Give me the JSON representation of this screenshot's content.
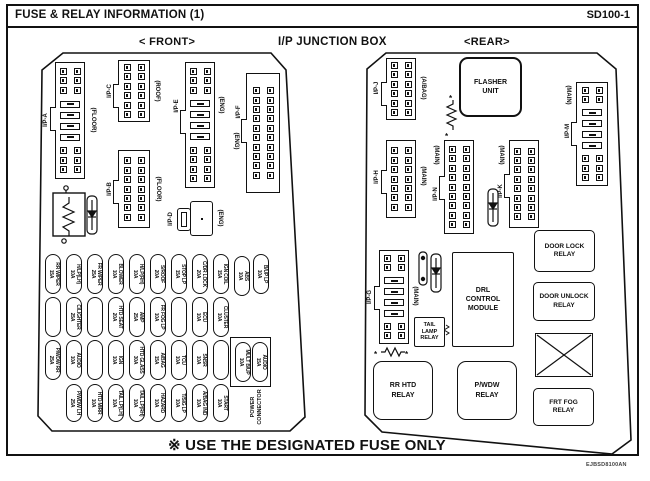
{
  "header": {
    "title": "FUSE & RELAY INFORMATION (1)",
    "page_code": "SD100-1"
  },
  "sections": {
    "front": "< FRONT>",
    "center": "I/P JUNCTION BOX",
    "rear": "<REAR>"
  },
  "footer": {
    "note": "※ USE THE DESIGNATED FUSE ONLY",
    "doc_code": "EJBSD8100AN"
  },
  "connectors": {
    "ipa": {
      "name": "I/P-A",
      "loc": "(FLOOR)"
    },
    "ipb": {
      "name": "I/P-B",
      "loc": "(FLOOR)"
    },
    "ipc": {
      "name": "I/P-C",
      "loc": "(ROOF)"
    },
    "ipd": {
      "name": "I/P-D",
      "loc": "(ENG)"
    },
    "ipe": {
      "name": "I/P-E",
      "loc": "(ENG)"
    },
    "ipf": {
      "name": "I/P-F",
      "loc": "(ENG)"
    },
    "ipg": {
      "name": "I/P-G",
      "loc": "(MAIN)"
    },
    "iph": {
      "name": "I/P-H",
      "loc": "(MAIN)"
    },
    "ipj": {
      "name": "I/P-J",
      "loc": "(A/BAG)"
    },
    "ipk": {
      "name": "I/P-K",
      "loc": "(MAIN)"
    },
    "ipm": {
      "name": "I/P-M",
      "loc": "(MAIN)"
    },
    "ipn": {
      "name": "I/P-N",
      "loc": "(MAIN)"
    }
  },
  "relays": {
    "flasher": "FLASHER\nUNIT",
    "tail_lamp": "TAIL\nLAMP\nRELAY",
    "drl": "DRL\nCONTROL\nMODULE",
    "rr_htd": "RR HTD\nRELAY",
    "pwdw": "P/WDW\nRELAY",
    "door_lock": "DOOR LOCK\nRELAY",
    "door_unlock": "DOOR UNLOCK\nRELAY",
    "frt_fog": "FRT FOG\nRELAY"
  },
  "fuse_panel": {
    "power_connector": [
      "POWER",
      "CONNECTOR"
    ],
    "rows": [
      [
        {
          "name": "RR WIPER",
          "amp": "15A"
        },
        {
          "name": "H/LP(LH)",
          "amp": "10A"
        },
        {
          "name": "FR WIPER",
          "amp": "25A"
        },
        {
          "name": "BLOWER",
          "amp": "10A"
        },
        {
          "name": "H/LP(RH)",
          "amp": "10A"
        },
        {
          "name": "S/ROOF",
          "amp": "20A"
        },
        {
          "name": "STOP LP",
          "amp": "15A"
        },
        {
          "name": "C/DR LOCK",
          "amp": "20A"
        },
        {
          "name": "IGN COIL",
          "amp": "15A"
        },
        {
          "name": "ABS",
          "amp": "10A"
        },
        {
          "name": "B/UP LP",
          "amp": "10A"
        }
      ],
      [
        null,
        {
          "name": "C/LIGHTER",
          "amp": "25A"
        },
        null,
        {
          "name": "HTD SEAT",
          "amp": "20A"
        },
        {
          "name": "AMP",
          "amp": "25A"
        },
        {
          "name": "FR FOG LP",
          "amp": "10A"
        },
        null,
        {
          "name": "ECU",
          "amp": "10A"
        },
        {
          "name": "CLUSTER",
          "amp": "10A"
        }
      ],
      [
        {
          "name": "P/WDW RR",
          "amp": "25A"
        },
        {
          "name": "AUDIO",
          "amp": "10A"
        },
        null,
        {
          "name": "IGN",
          "amp": "10A"
        },
        {
          "name": "HTD GLASS",
          "amp": "30A"
        },
        {
          "name": "A/BAG",
          "amp": "15A"
        },
        {
          "name": "TCU",
          "amp": "10A"
        },
        {
          "name": "SNSR",
          "amp": "10A"
        },
        null,
        {
          "name": "MULT B/UP",
          "amp": "10A"
        },
        {
          "name": "AUDIO",
          "amp": "15A"
        }
      ],
      [
        {
          "name": "P/WDW LH",
          "amp": "25A"
        },
        {
          "name": "HTD MIRR",
          "amp": "10A"
        },
        {
          "name": "TAIL LP(LH)",
          "amp": "10A"
        },
        {
          "name": "TAIL LP(RH)",
          "amp": "10A"
        },
        {
          "name": "HAZARD",
          "amp": "10A"
        },
        {
          "name": "T/SIG LP",
          "amp": "10A"
        },
        {
          "name": "A/BAG IND",
          "amp": "10A"
        },
        {
          "name": "START",
          "amp": "10A"
        }
      ]
    ]
  }
}
